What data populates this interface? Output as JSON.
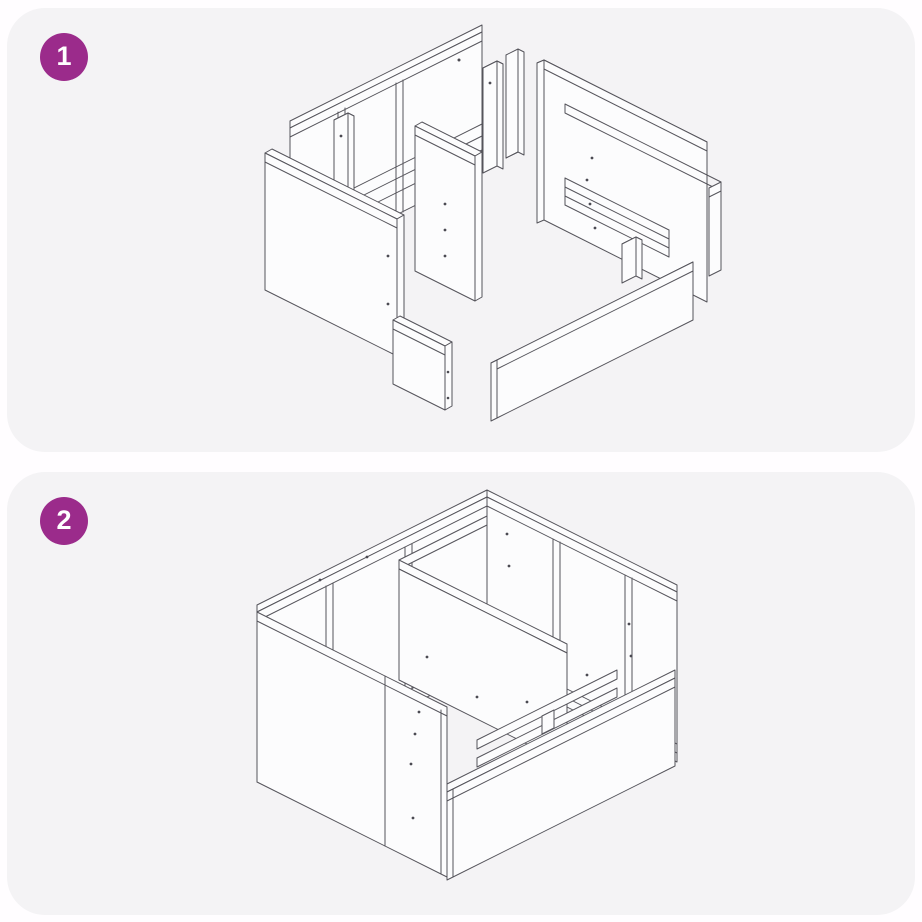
{
  "page": {
    "background": "#FFFDFF"
  },
  "card": {
    "background": "#F4F3F5",
    "corner_radius_px": 38
  },
  "badge": {
    "background": "#9B2B8B",
    "text_color": "#FFFFFF"
  },
  "illustration_style": {
    "stroke": "#55545B",
    "panel_fill": "#FCFCFD",
    "screw_hole_dot": "#4B4A52"
  },
  "steps": [
    {
      "number": "1",
      "illustration": "exploded-panels-isometric-view"
    },
    {
      "number": "2",
      "illustration": "assembled-box-isometric-view"
    }
  ]
}
